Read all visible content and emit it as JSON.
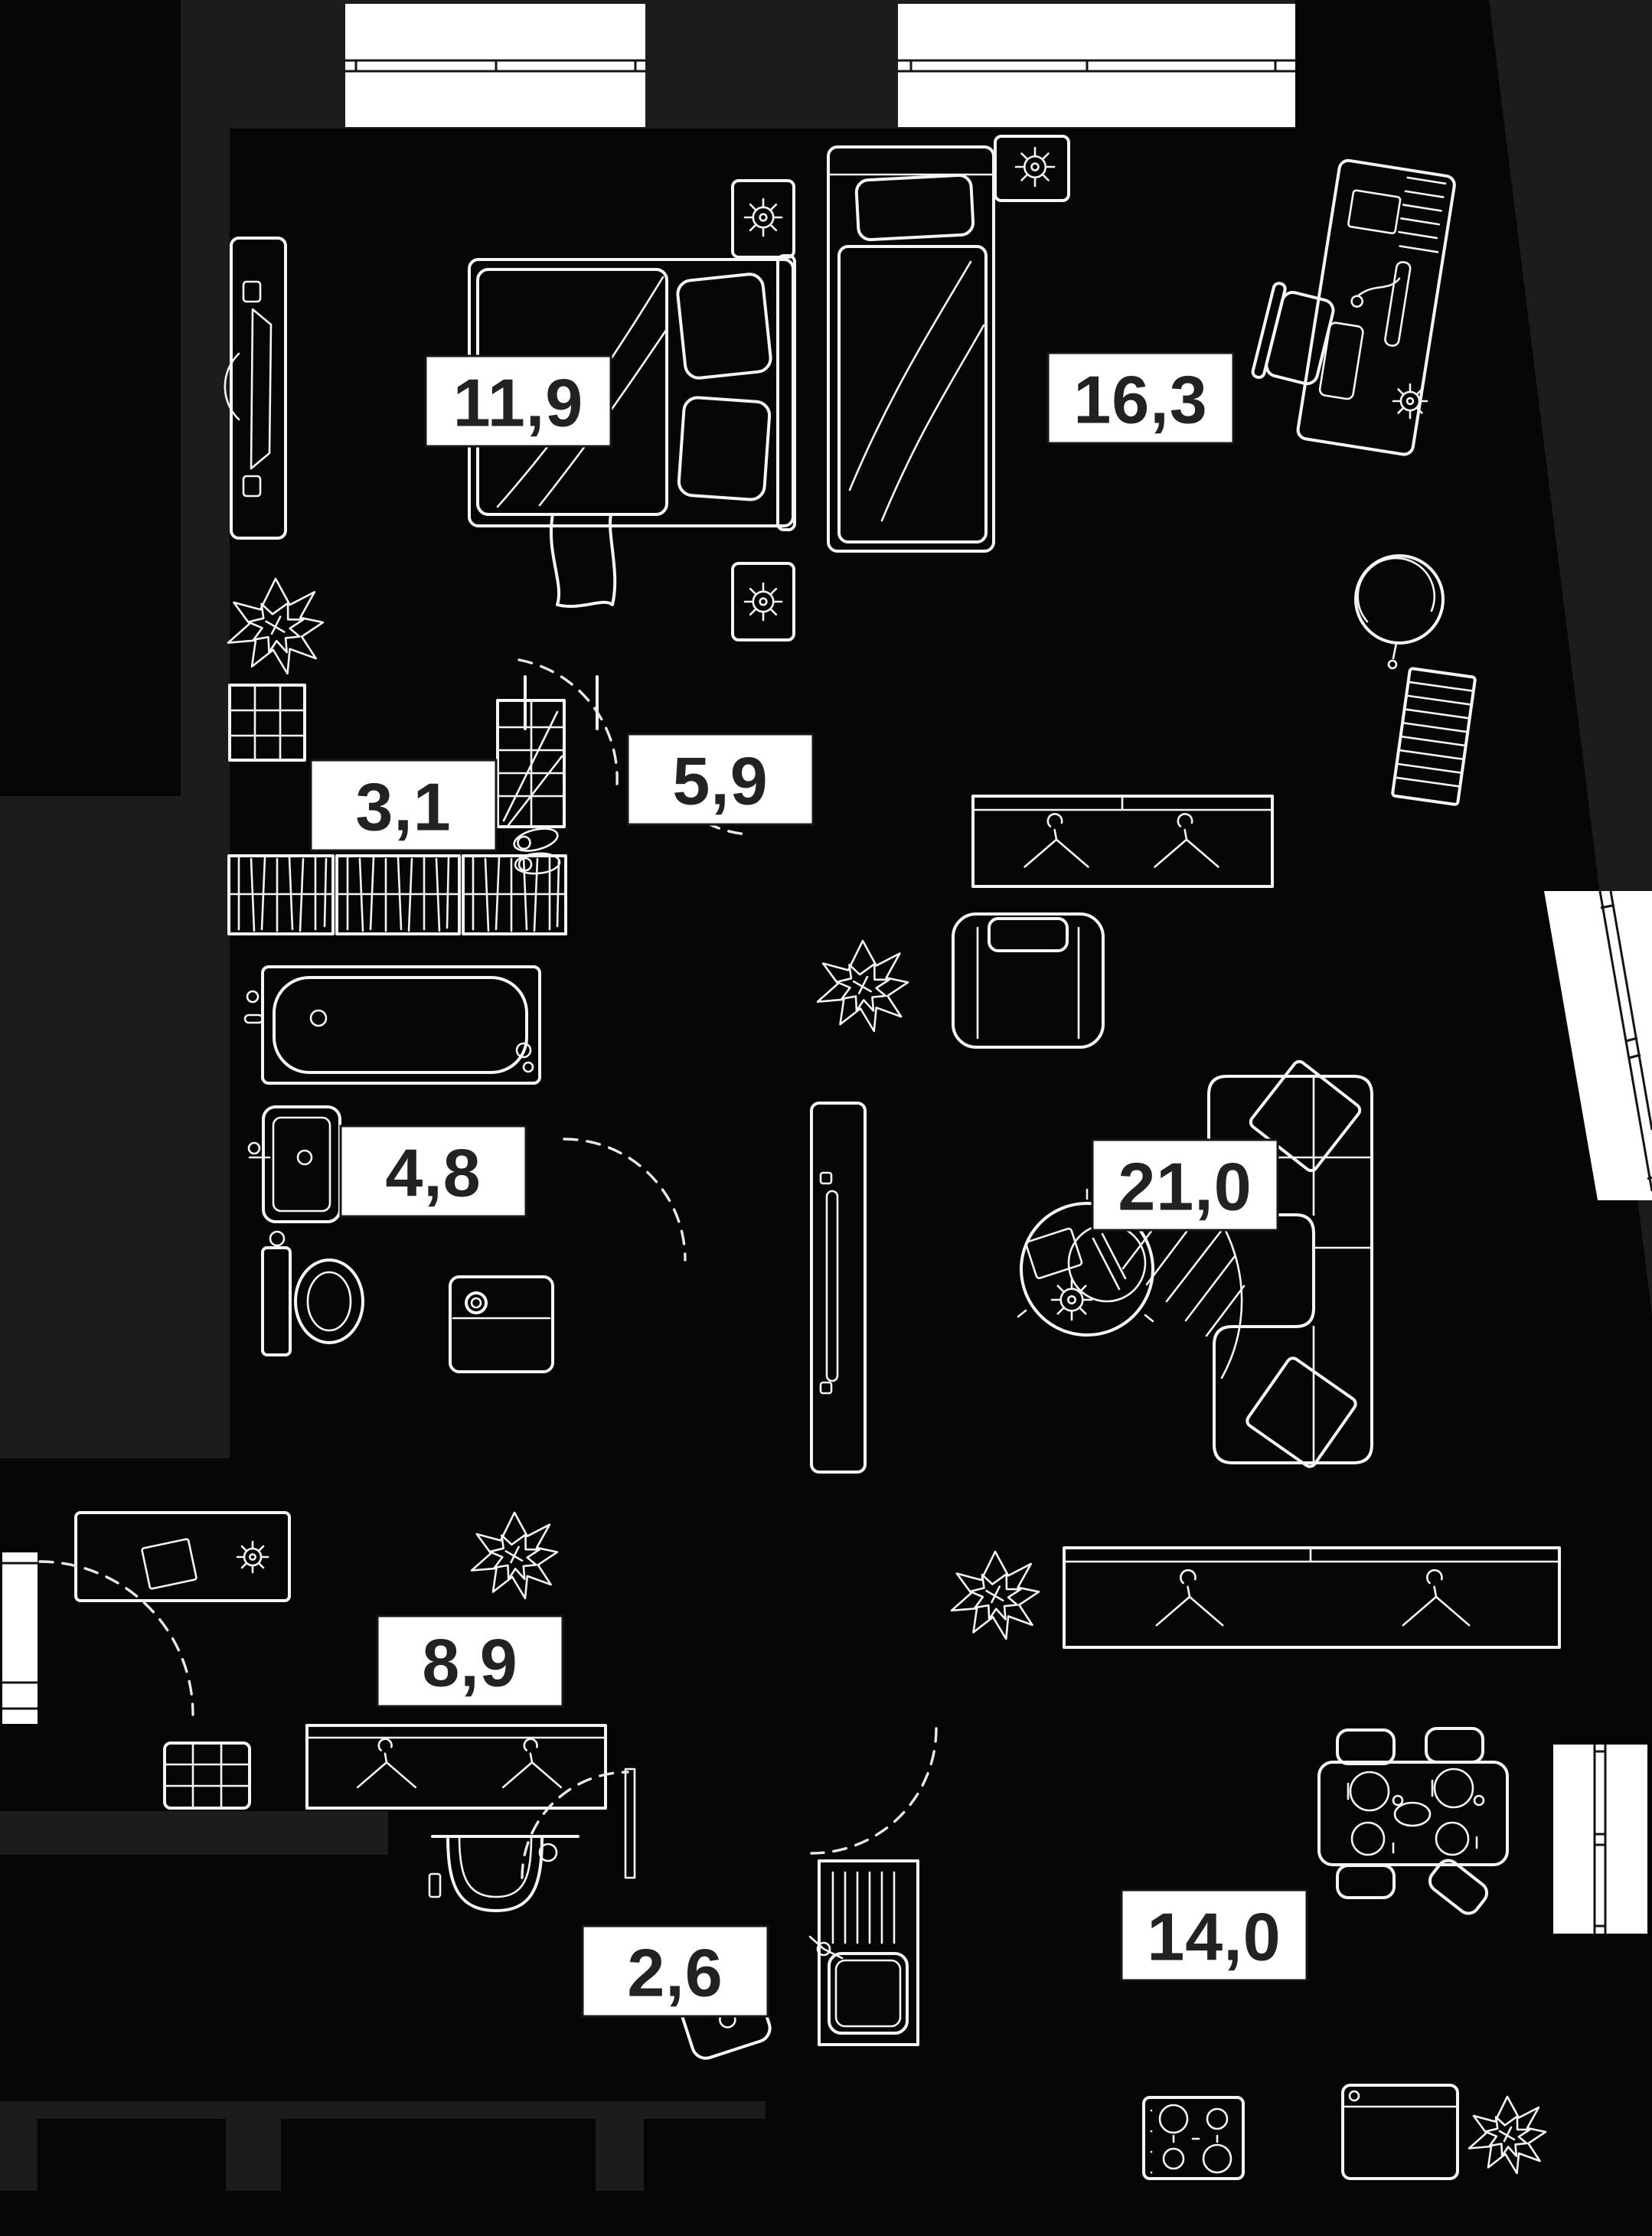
{
  "plan": {
    "title": "apartment floor plan",
    "area_unit": "m2",
    "rooms": [
      {
        "name": "bedroom",
        "area_label": "11,9"
      },
      {
        "name": "bedroom-2",
        "area_label": "16,3"
      },
      {
        "name": "walk-in-closet",
        "area_label": "3,1"
      },
      {
        "name": "hall",
        "area_label": "5,9"
      },
      {
        "name": "bathroom",
        "area_label": "4,8"
      },
      {
        "name": "living-room",
        "area_label": "21,0"
      },
      {
        "name": "hallway",
        "area_label": "8,9"
      },
      {
        "name": "wc",
        "area_label": "2,6"
      },
      {
        "name": "kitchen",
        "area_label": "14,0"
      }
    ],
    "colors": {
      "background": "#1c1c1c",
      "building": "#060606",
      "furniture_line": "#f4f4f4",
      "window_fill": "#ffffff",
      "window_frame": "#141414",
      "label_background": "#ffffff",
      "label_text": "#222222"
    }
  }
}
